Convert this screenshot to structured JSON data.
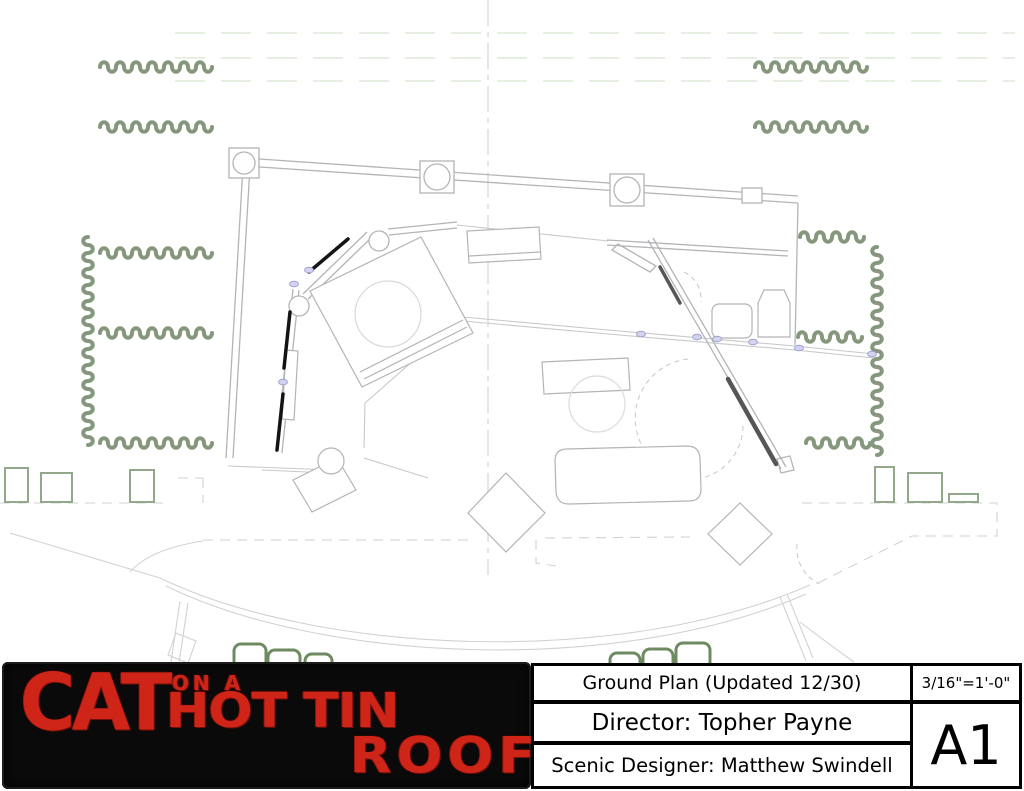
{
  "title_block": {
    "drawing_title": "Ground Plan (Updated 12/30)",
    "director": "Director: Topher Payne",
    "designer": "Scenic Designer: Matthew Swindell",
    "scale": "3/16\"=1'-0\"",
    "sheet_number": "A1"
  },
  "logo": {
    "line1": "CAT",
    "line2": "ON A",
    "line3": "HOT TIN",
    "line4": "ROOF"
  },
  "colors": {
    "wall_gray": "#b4b4b8",
    "faint_gray": "#d2d2d6",
    "very_faint_gray": "#dcdcdf",
    "curtain_green": "#85987d",
    "masking_green": "#93a78b",
    "seat_green": "#6e8a60",
    "spike_green_dashed": "#dfe9dc",
    "centerline_green": "#ccd5cc",
    "hinge_lavender": "#d3d3ef",
    "door_black": "#141414",
    "door_dark_gray": "#565656",
    "logo_red": "#cf2519",
    "logo_background": "#0a0a0a"
  }
}
